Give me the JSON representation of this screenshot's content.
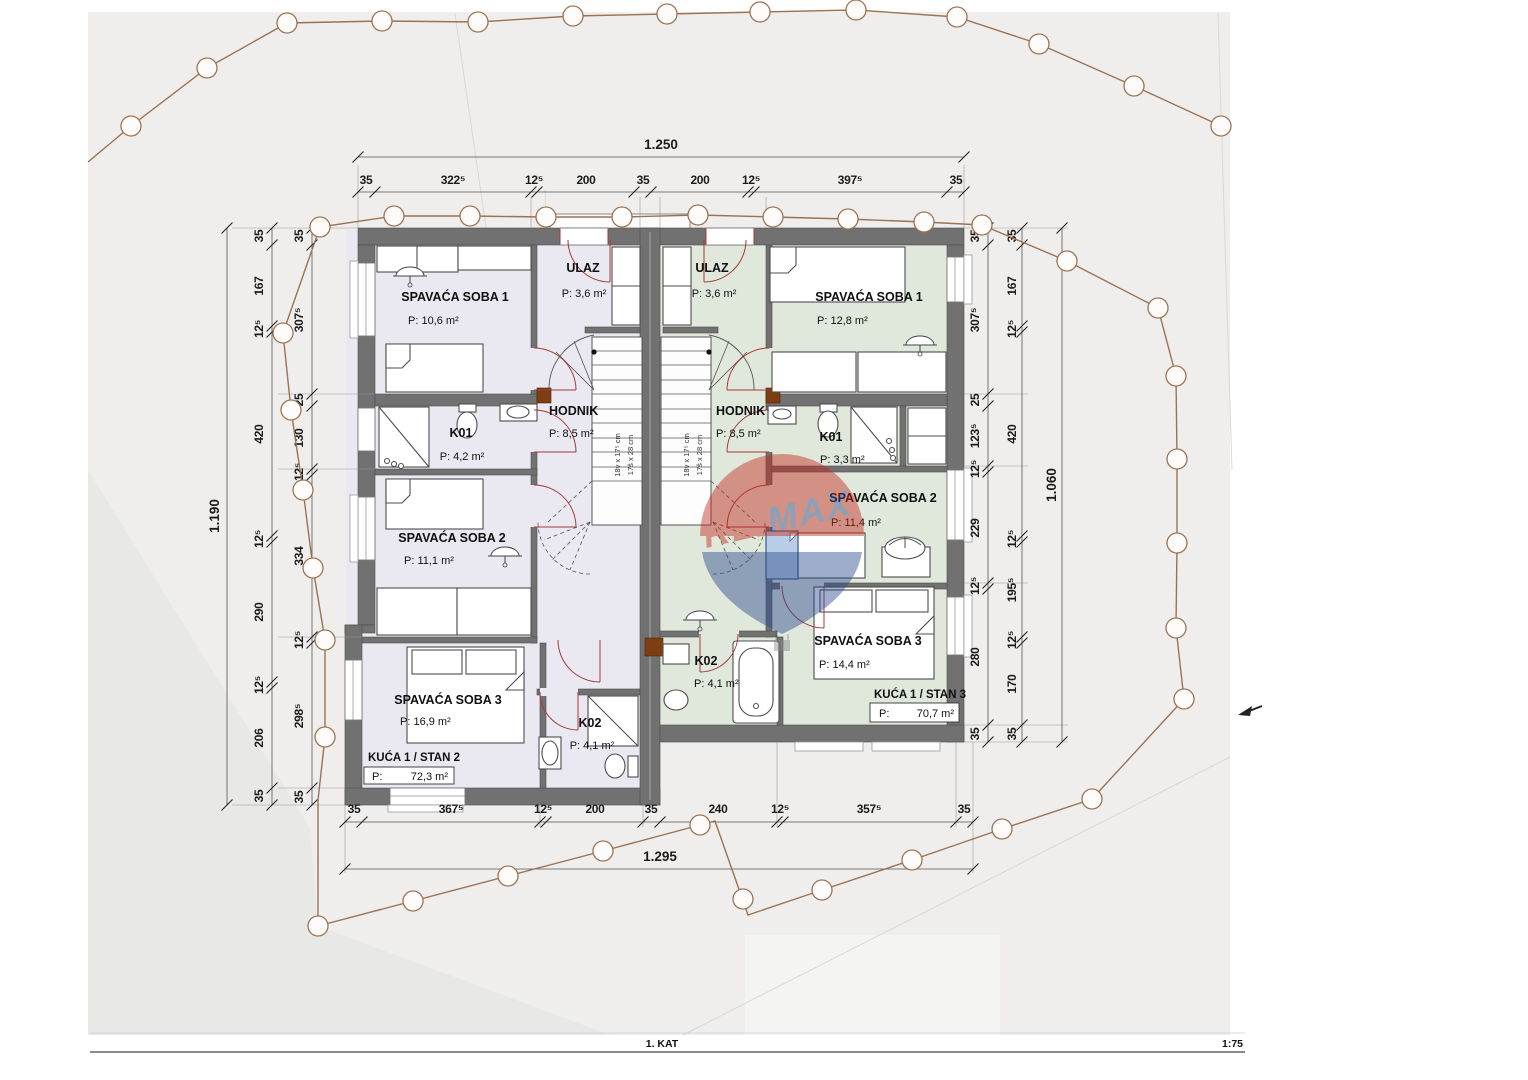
{
  "title_block": {
    "floor": "1. KAT",
    "scale": "1:75"
  },
  "watermark": {
    "part1": "RE",
    "slash": "/",
    "part2": "MAX",
    "color_red": "#c5281c",
    "color_blue": "#2a4b8f"
  },
  "stairs": {
    "note1": "18v x 17⁵ cm",
    "note2": "17š x 28 cm"
  },
  "dims": {
    "top_total": "1.250",
    "top": [
      "35",
      "322⁵",
      "12⁵",
      "200",
      "35",
      "200",
      "12⁵",
      "397⁵",
      "35"
    ],
    "bottom": [
      "35",
      "367⁵",
      "12⁵",
      "200",
      "35",
      "240",
      "12⁵",
      "357⁵",
      "35"
    ],
    "bottom_total": "1.295",
    "left_total": "1.190",
    "left_outer": [
      "35",
      "167",
      "12⁵",
      "420",
      "12⁵",
      "290",
      "12⁵",
      "206",
      "35"
    ],
    "left_inner": [
      "35",
      "307⁵",
      "25",
      "130",
      "12⁵",
      "334",
      "12⁵",
      "298⁵",
      "35"
    ],
    "right_inner": [
      "35",
      "307⁵",
      "25",
      "123⁵",
      "12⁵",
      "229",
      "12⁵",
      "280",
      "35"
    ],
    "right_outer": [
      "35",
      "167",
      "12⁵",
      "420",
      "12⁵",
      "195⁵",
      "12⁵",
      "170",
      "35"
    ],
    "right_total": "1.060"
  },
  "units": {
    "left": {
      "label": "KUĆA 1 / STAN 2",
      "area_prefix": "P:",
      "area_value": "72,3 m²",
      "rooms": {
        "bedroom1": {
          "name": "SPAVAĆA SOBA 1",
          "area": "P: 10,6 m²"
        },
        "entry": {
          "name": "ULAZ",
          "area": "P: 3,6 m²"
        },
        "hallway": {
          "name": "HODNIK",
          "area": "P: 8,5 m²"
        },
        "bath1": {
          "name": "K01",
          "area": "P: 4,2 m²"
        },
        "bedroom2": {
          "name": "SPAVAĆA SOBA 2",
          "area": "P: 11,1 m²"
        },
        "bedroom3": {
          "name": "SPAVAĆA SOBA 3",
          "area": "P: 16,9 m²"
        },
        "bath2": {
          "name": "K02",
          "area": "P: 4,1 m²"
        }
      }
    },
    "right": {
      "label": "KUĆA 1 / STAN 3",
      "area_prefix": "P:",
      "area_value": "70,7 m²",
      "rooms": {
        "entry": {
          "name": "ULAZ",
          "area": "P: 3,6 m²"
        },
        "bedroom1": {
          "name": "SPAVAĆA SOBA 1",
          "area": "P: 12,8 m²"
        },
        "hallway": {
          "name": "HODNIK",
          "area": "P: 8,5 m²"
        },
        "bath1": {
          "name": "K01",
          "area": "P: 3,3 m²"
        },
        "bedroom2": {
          "name": "SPAVAĆA SOBA 2",
          "area": "P: 11,4 m²"
        },
        "bedroom3": {
          "name": "SPAVAĆA SOBA 3",
          "area": "P: 14,4 m²"
        },
        "bath2": {
          "name": "K02",
          "area": "P: 4,1 m²"
        }
      }
    }
  },
  "colors": {
    "left_floor": "#eae9f1",
    "right_floor": "#e0e7db",
    "wall": "#717171",
    "boundary": "#9b7352",
    "door": "#a33b36",
    "accent_block": "#7d3f12"
  }
}
